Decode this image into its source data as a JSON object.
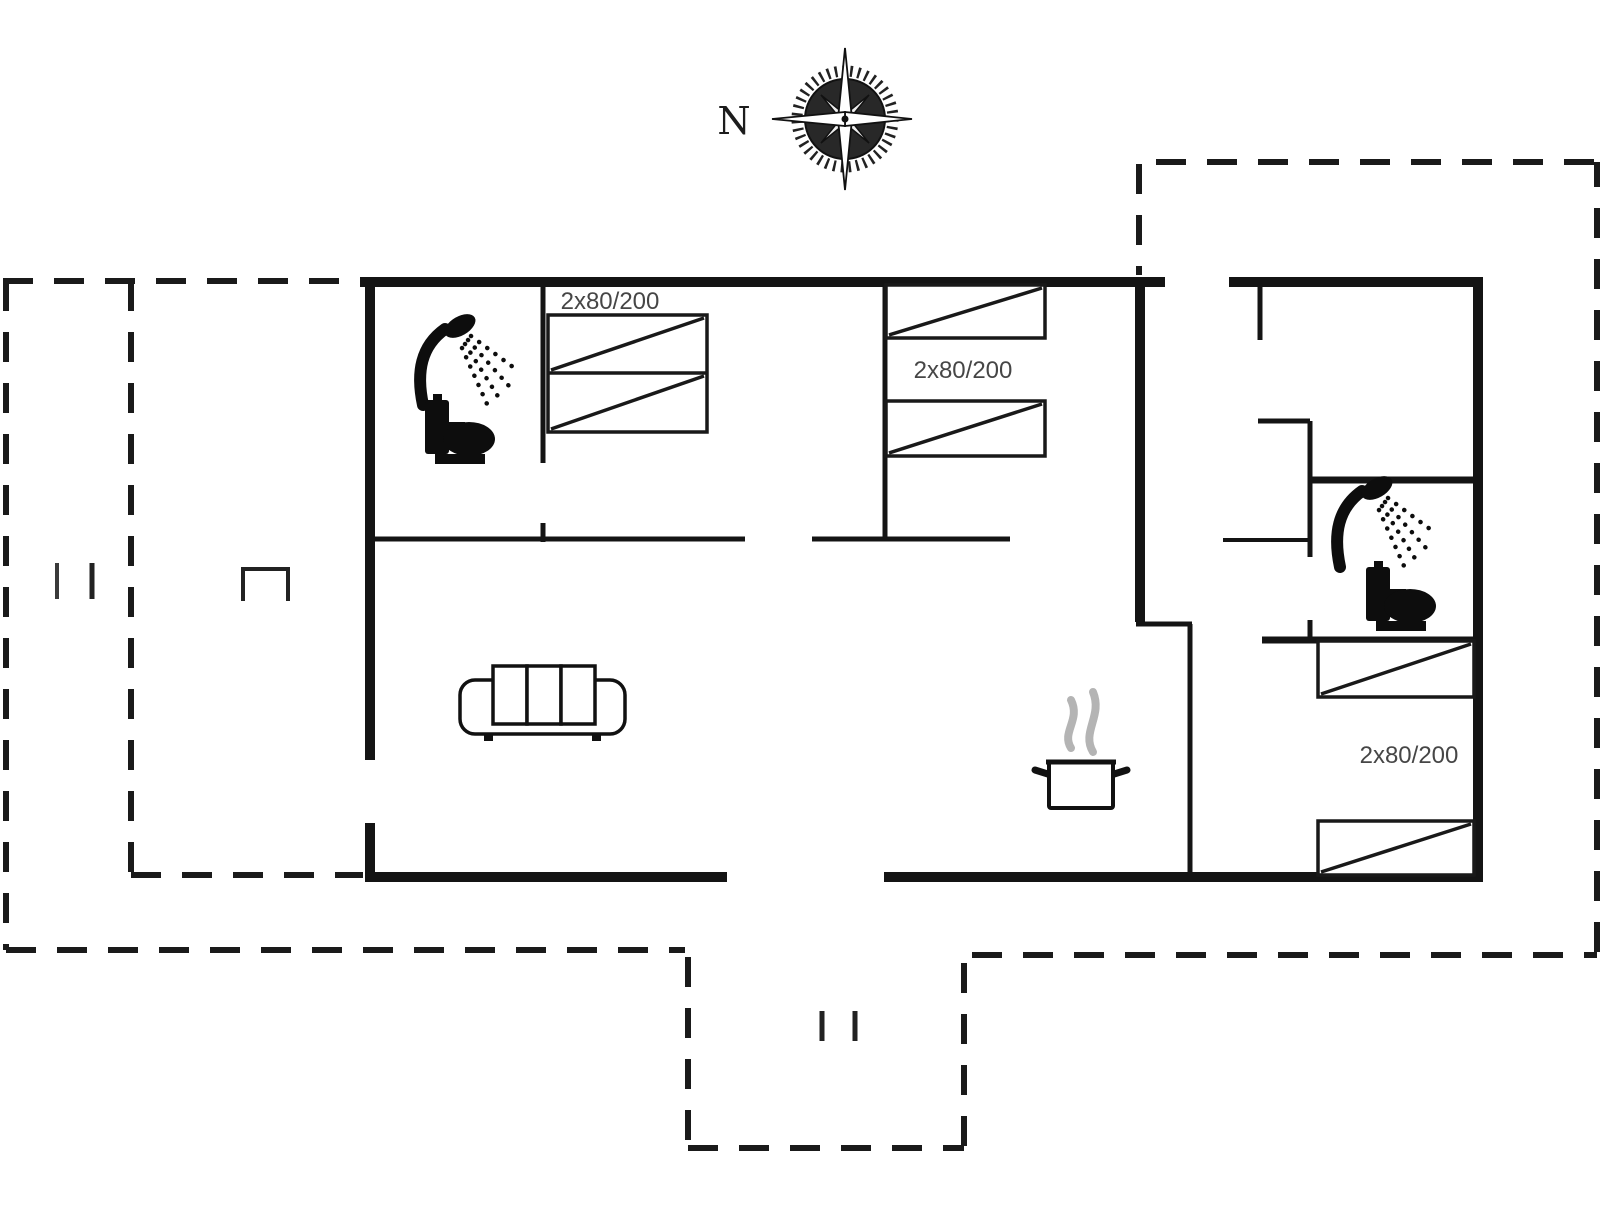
{
  "plan": {
    "compass_label": "N",
    "bed_labels": {
      "bedroom1": "2x80/200",
      "bedroom2": "2x80/200",
      "bedroom3": "2x80/200"
    },
    "colors": {
      "wall": "#141414",
      "label_text": "#464646",
      "steam": "#b4b4b4",
      "background": "#ffffff"
    },
    "icons": [
      "compass-rose-icon",
      "shower-icon",
      "toilet-icon",
      "sofa-icon",
      "cooking-pot-icon",
      "steam-icon",
      "door-tick-marks"
    ]
  }
}
